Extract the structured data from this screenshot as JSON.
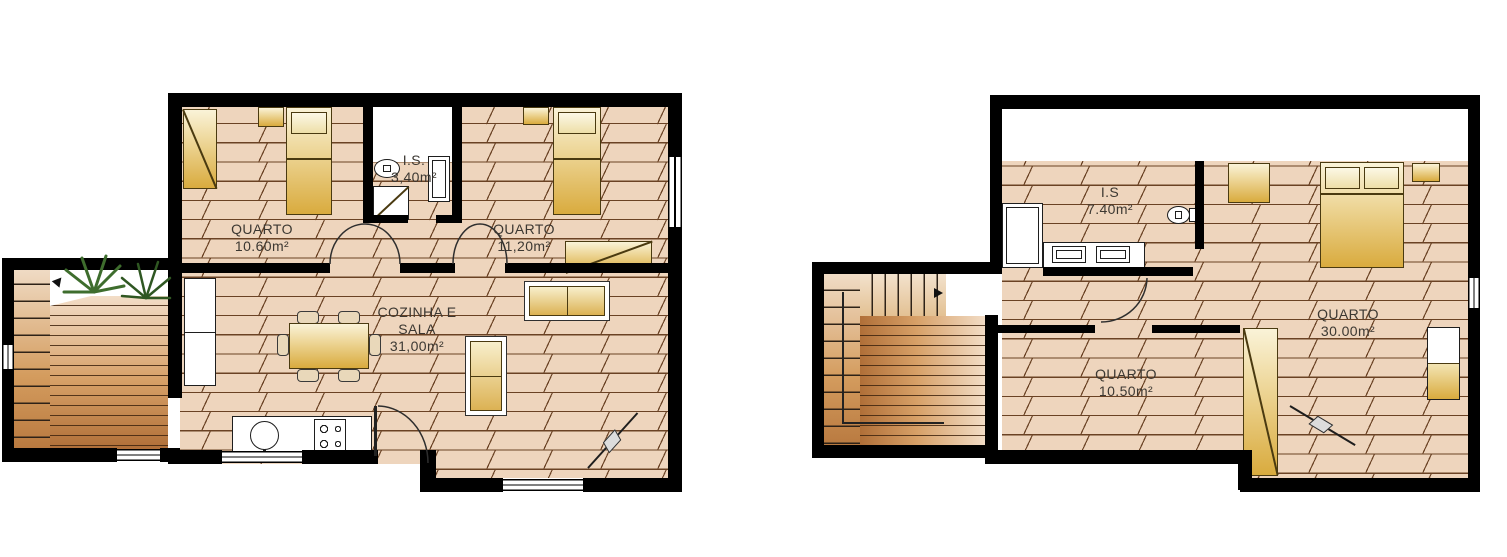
{
  "palette": {
    "wall": "#000000",
    "floor_base": "#eed5bd",
    "plank_line": "#6a4224",
    "deck_dark": "#b06f38",
    "deck_light": "#f2ddc7",
    "furniture_gold": "#d9ab3e",
    "furniture_light": "#faf3d8",
    "fixture_white": "#ffffff",
    "plant_green": "#3e6d2d",
    "text": "#3c3832"
  },
  "left_plan": {
    "rooms": [
      {
        "name": "QUARTO",
        "area": "10.60m²"
      },
      {
        "name": "I.S.",
        "area": "3,40m²"
      },
      {
        "name": "QUARTO",
        "area": "11,20m²"
      },
      {
        "name": "COZINHA E",
        "name2": "SALA",
        "area": "31,00m²"
      }
    ]
  },
  "right_plan": {
    "rooms": [
      {
        "name": "I.S",
        "area": "7.40m²"
      },
      {
        "name": "QUARTO",
        "area": "30.00m²"
      },
      {
        "name": "QUARTO",
        "area": "10.50m²"
      }
    ]
  }
}
